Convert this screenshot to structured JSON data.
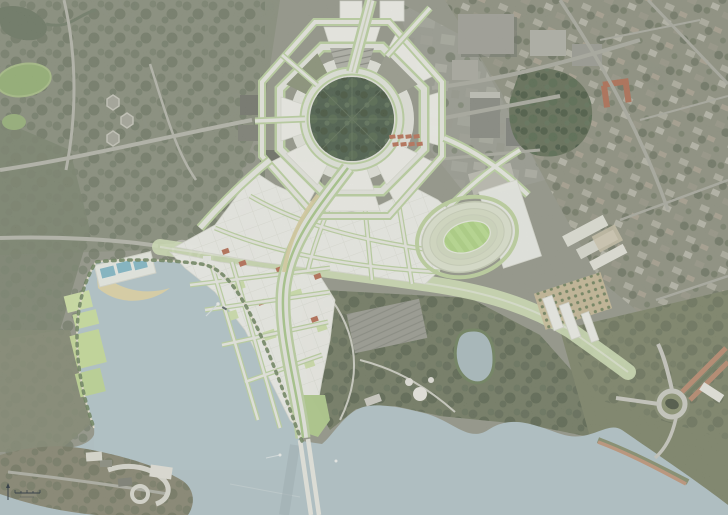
{
  "document": {
    "title": "Aerial masterplan render — hexagonal city hill precinct, stadium and lake waterfront",
    "type": "satellite-photo-with-masterplan-overlay",
    "width_px": 728,
    "height_px": 515
  },
  "palette": {
    "water": "#a9bec5",
    "plan_block_white": "#f4f5ef",
    "street_verge_green": "#b7d198",
    "plan_road": "#e9ebe3",
    "city_hill_trees": "#2f4530",
    "stadium_pitch": "#aed77c",
    "beach_sand": "#e3d49b",
    "pool_blue": "#6fb0c4",
    "accent_roof_red": "#b0593c",
    "parade_red": "#b07a5c",
    "photo_urban": "#84877a",
    "photo_forest": "#66705a",
    "photo_suburb": "#7b7e6d",
    "park_green": "#5e684d"
  },
  "landmarks": [
    {
      "label": "lake water — west basin"
    },
    {
      "label": "circular tree park on city hill"
    },
    {
      "label": "ring roads around city hill"
    },
    {
      "label": "proposed white city blocks"
    },
    {
      "label": "proposed oval stadium"
    },
    {
      "label": "green covered boulevard"
    },
    {
      "label": "waterfront park with pools and beach"
    },
    {
      "label": "avenue and lake bridge"
    },
    {
      "label": "lakeside parkland east of bridge"
    },
    {
      "label": "small park pond"
    },
    {
      "label": "lakeshore roundabout"
    },
    {
      "label": "red gravel parade"
    },
    {
      "label": "museum peninsula"
    },
    {
      "label": "campus and forest west side"
    },
    {
      "label": "inner suburb east side"
    },
    {
      "label": "north arrow"
    },
    {
      "label": "scale bar"
    }
  ],
  "boats": {
    "count": 4
  }
}
